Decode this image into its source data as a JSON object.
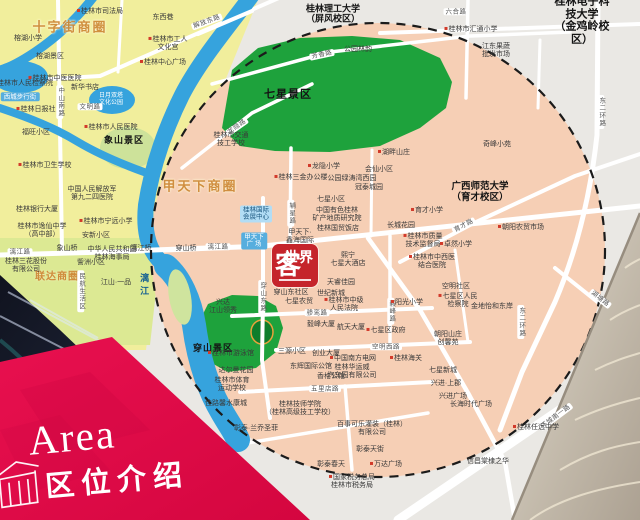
{
  "banner": {
    "title_en": "Area",
    "title_zh": "区位介绍"
  },
  "logo": {
    "char_main": "客",
    "char_sub": "世界",
    "name": "客世界"
  },
  "colors": {
    "banner_red": "#e2094a",
    "logo_red": "#c5242b",
    "map_salmon": "#f6cfb5",
    "map_yellow": "#f1ee9c",
    "park_green": "#1ea23c",
    "water_blue": "#36a3dd",
    "circle_dash": "#1b1b1b",
    "business_circle_text": "#cf8b3a",
    "texture_tan": "#b3a99b"
  },
  "map": {
    "labels": [
      {
        "t": "十字街商圈",
        "x": 70,
        "y": 28,
        "k": "area"
      },
      {
        "t": "甲天下商圈",
        "x": 200,
        "y": 187,
        "k": "area"
      },
      {
        "t": "联达商圈",
        "x": 57,
        "y": 277,
        "k": "area2"
      },
      {
        "t": "七星景区",
        "x": 288,
        "y": 95,
        "k": "district",
        "s": 11
      },
      {
        "t": "穿山景区",
        "x": 213,
        "y": 348,
        "k": "district",
        "s": 9
      },
      {
        "t": "象山景区",
        "x": 124,
        "y": 140,
        "k": "district",
        "s": 9
      },
      {
        "t": "桂林理工大学\n（屏风校区）",
        "x": 333,
        "y": 14,
        "k": "uni",
        "s": 9
      },
      {
        "t": "桂林电子科技大学\n（金鸡岭校区）",
        "x": 582,
        "y": 21,
        "k": "uni",
        "s": 11
      },
      {
        "t": "广西师范大学\n（育才校区）",
        "x": 480,
        "y": 193,
        "k": "uni",
        "s": 9.5
      },
      {
        "t": "漓江",
        "x": 144,
        "y": 286,
        "k": "water"
      },
      {
        "t": "日月双塔\n文化公园",
        "x": 111,
        "y": 100,
        "k": "lakelabel"
      },
      {
        "t": "解放东路",
        "x": 207,
        "y": 22,
        "k": "road",
        "rot": -20
      },
      {
        "t": "六合路",
        "x": 456,
        "y": 12,
        "k": "road"
      },
      {
        "t": "芳香路",
        "x": 322,
        "y": 55,
        "k": "road",
        "rot": -12
      },
      {
        "t": "龙隐路",
        "x": 237,
        "y": 127,
        "k": "road",
        "rot": -35
      },
      {
        "t": "中山南路",
        "x": 60,
        "y": 102,
        "k": "roadv"
      },
      {
        "t": "文明路",
        "x": 90,
        "y": 107,
        "k": "road"
      },
      {
        "t": "漓江路",
        "x": 20,
        "y": 252,
        "k": "road"
      },
      {
        "t": "漓江路",
        "x": 218,
        "y": 247,
        "k": "road"
      },
      {
        "t": "穿山东路",
        "x": 262,
        "y": 297,
        "k": "roadv"
      },
      {
        "t": "辅星路",
        "x": 291,
        "y": 213,
        "k": "roadv"
      },
      {
        "t": "骖鸾路",
        "x": 317,
        "y": 313,
        "k": "road"
      },
      {
        "t": "毅峰路",
        "x": 391,
        "y": 311,
        "k": "roadv"
      },
      {
        "t": "空明西路",
        "x": 386,
        "y": 347,
        "k": "road"
      },
      {
        "t": "五里店路",
        "x": 325,
        "y": 389,
        "k": "road"
      },
      {
        "t": "育才路",
        "x": 464,
        "y": 226,
        "k": "road",
        "rot": -28
      },
      {
        "t": "东二环路",
        "x": 601,
        "y": 112,
        "k": "roadv"
      },
      {
        "t": "东二环路",
        "x": 521,
        "y": 322,
        "k": "roadv"
      },
      {
        "t": "环城南一路",
        "x": 556,
        "y": 417,
        "k": "road",
        "rot": -37
      },
      {
        "t": "湖塘路",
        "x": 600,
        "y": 299,
        "k": "road",
        "rot": 38
      },
      {
        "t": "象山桥",
        "x": 67,
        "y": 249,
        "k": "place"
      },
      {
        "t": "漓江桥",
        "x": 141,
        "y": 249,
        "k": "place"
      },
      {
        "t": "穿山桥",
        "x": 186,
        "y": 249,
        "k": "place"
      },
      {
        "t": "东西巷",
        "x": 163,
        "y": 18,
        "k": "place"
      },
      {
        "t": "桂林市司法局",
        "x": 100,
        "y": 12,
        "k": "dot"
      },
      {
        "t": "桂林市工人\n文化宫",
        "x": 168,
        "y": 44,
        "k": "dot"
      },
      {
        "t": "桂林中心广场",
        "x": 163,
        "y": 63,
        "k": "dot"
      },
      {
        "t": "榕湖小学",
        "x": 28,
        "y": 39,
        "k": "place"
      },
      {
        "t": "榕湖景区",
        "x": 50,
        "y": 57,
        "k": "place"
      },
      {
        "t": "桂林市中医医院",
        "x": 55,
        "y": 79,
        "k": "dot"
      },
      {
        "t": "新华书店",
        "x": 85,
        "y": 88,
        "k": "place"
      },
      {
        "t": "西城步行街",
        "x": 20,
        "y": 97,
        "k": "blueboxw"
      },
      {
        "t": "桂林市人民检察院",
        "x": 25,
        "y": 84,
        "k": "place"
      },
      {
        "t": "桂林日报社",
        "x": 36,
        "y": 110,
        "k": "dot"
      },
      {
        "t": "桂林市人民医院",
        "x": 111,
        "y": 128,
        "k": "dot"
      },
      {
        "t": "福旺小区",
        "x": 36,
        "y": 133,
        "k": "place"
      },
      {
        "t": "桂林市卫生学校",
        "x": 45,
        "y": 166,
        "k": "dot"
      },
      {
        "t": "中国人民解放军\n第九二四医院",
        "x": 92,
        "y": 194,
        "k": "place"
      },
      {
        "t": "桂林银行大厦",
        "x": 37,
        "y": 210,
        "k": "place"
      },
      {
        "t": "桂林市逸仙中学\n（高中部）",
        "x": 42,
        "y": 231,
        "k": "place"
      },
      {
        "t": "桂林市宁远小学",
        "x": 106,
        "y": 222,
        "k": "dot"
      },
      {
        "t": "安新小区",
        "x": 96,
        "y": 236,
        "k": "place"
      },
      {
        "t": "中华人民共和国\n桂林海事局",
        "x": 112,
        "y": 254,
        "k": "place"
      },
      {
        "t": "訾洲小区",
        "x": 91,
        "y": 263,
        "k": "place"
      },
      {
        "t": "民航生活区",
        "x": 81,
        "y": 291,
        "k": "roadv"
      },
      {
        "t": "江山·一品",
        "x": 116,
        "y": 283,
        "k": "place"
      },
      {
        "t": "桂林三花股份\n有限公司",
        "x": 26,
        "y": 266,
        "k": "place"
      },
      {
        "t": "桂林市交通\n技工学校",
        "x": 231,
        "y": 140,
        "k": "place"
      },
      {
        "t": "公园林韵",
        "x": 358,
        "y": 50,
        "k": "place"
      },
      {
        "t": "湖畔山庄",
        "x": 394,
        "y": 153,
        "k": "dot"
      },
      {
        "t": "龙隐小学",
        "x": 324,
        "y": 167,
        "k": "dot"
      },
      {
        "t": "会仙小区",
        "x": 379,
        "y": 170,
        "k": "place"
      },
      {
        "t": "公园绿涛湾西园",
        "x": 352,
        "y": 179,
        "k": "place"
      },
      {
        "t": "冠泰城园",
        "x": 369,
        "y": 188,
        "k": "place"
      },
      {
        "t": "七星小区",
        "x": 331,
        "y": 200,
        "k": "place"
      },
      {
        "t": "桂林三金办公楼",
        "x": 301,
        "y": 178,
        "k": "dot"
      },
      {
        "t": "桂林国际\n会展中心",
        "x": 256,
        "y": 214,
        "k": "bluebox"
      },
      {
        "t": "甲天下\n广 场",
        "x": 254,
        "y": 241,
        "k": "blueboxw"
      },
      {
        "t": "中国有色桂林\n矿产地质研究院",
        "x": 337,
        "y": 215,
        "k": "place"
      },
      {
        "t": "桂林国贸饭店",
        "x": 338,
        "y": 229,
        "k": "place"
      },
      {
        "t": "长城花园",
        "x": 401,
        "y": 226,
        "k": "place"
      },
      {
        "t": "桂林市质量\n技术监督局",
        "x": 423,
        "y": 241,
        "k": "dot"
      },
      {
        "t": "育才小学",
        "x": 427,
        "y": 211,
        "k": "dot"
      },
      {
        "t": "奇峰小苑",
        "x": 497,
        "y": 145,
        "k": "place"
      },
      {
        "t": "朝阳农贸市场",
        "x": 521,
        "y": 228,
        "k": "dot"
      },
      {
        "t": "卓然小学",
        "x": 456,
        "y": 245,
        "k": "dot"
      },
      {
        "t": "桂林市中西医\n结合医院",
        "x": 432,
        "y": 262,
        "k": "dot"
      },
      {
        "t": "桂林市汇通小学",
        "x": 471,
        "y": 30,
        "k": "dot"
      },
      {
        "t": "江东果蔬\n批发市场",
        "x": 496,
        "y": 51,
        "k": "place"
      },
      {
        "t": "甲天下·\n鑫海国际",
        "x": 300,
        "y": 237,
        "k": "place"
      },
      {
        "t": "熙宁\n七星大酒店",
        "x": 348,
        "y": 260,
        "k": "place"
      },
      {
        "t": "天睿佳园",
        "x": 341,
        "y": 283,
        "k": "place"
      },
      {
        "t": "世纪新城",
        "x": 331,
        "y": 294,
        "k": "place"
      },
      {
        "t": "桂林市中级\n人民法院",
        "x": 344,
        "y": 305,
        "k": "dot"
      },
      {
        "t": "穿山东社区",
        "x": 291,
        "y": 293,
        "k": "place"
      },
      {
        "t": "七星农贸",
        "x": 299,
        "y": 302,
        "k": "place"
      },
      {
        "t": "毅峰大厦",
        "x": 321,
        "y": 325,
        "k": "place"
      },
      {
        "t": "航天大厦",
        "x": 351,
        "y": 328,
        "k": "place"
      },
      {
        "t": "七星区政府",
        "x": 386,
        "y": 331,
        "k": "dot"
      },
      {
        "t": "阳光小学",
        "x": 407,
        "y": 303,
        "k": "dot"
      },
      {
        "t": "空明社区",
        "x": 456,
        "y": 287,
        "k": "place"
      },
      {
        "t": "七星区人民\n检察院",
        "x": 458,
        "y": 301,
        "k": "dot"
      },
      {
        "t": "金地怡和东岸",
        "x": 492,
        "y": 307,
        "k": "place"
      },
      {
        "t": "朝阳山庄\n创馨苑",
        "x": 448,
        "y": 339,
        "k": "place"
      },
      {
        "t": "七星新城",
        "x": 443,
        "y": 371,
        "k": "place"
      },
      {
        "t": "兴进·上郡",
        "x": 446,
        "y": 384,
        "k": "place"
      },
      {
        "t": "兴进广场",
        "x": 453,
        "y": 397,
        "k": "place"
      },
      {
        "t": "长海时代广场",
        "x": 471,
        "y": 405,
        "k": "place"
      },
      {
        "t": "桂林任远中学",
        "x": 536,
        "y": 428,
        "k": "dot"
      },
      {
        "t": "信昌棠棣之华",
        "x": 488,
        "y": 462,
        "k": "place"
      },
      {
        "t": "兴达\n江山领秀",
        "x": 223,
        "y": 307,
        "k": "place"
      },
      {
        "t": "桂林市游泳馆",
        "x": 231,
        "y": 354,
        "k": "dot"
      },
      {
        "t": "达尔曼花园",
        "x": 236,
        "y": 371,
        "k": "place"
      },
      {
        "t": "桂林市体育\n运动学校",
        "x": 232,
        "y": 385,
        "k": "place"
      },
      {
        "t": "佳路馨水康城",
        "x": 226,
        "y": 404,
        "k": "place"
      },
      {
        "t": "三源小区",
        "x": 292,
        "y": 352,
        "k": "place"
      },
      {
        "t": "创业大厦",
        "x": 326,
        "y": 354,
        "k": "place"
      },
      {
        "t": "东辉国际公馆",
        "x": 311,
        "y": 367,
        "k": "place"
      },
      {
        "t": "香格公馆",
        "x": 331,
        "y": 377,
        "k": "place"
      },
      {
        "t": "中国南方电网",
        "x": 353,
        "y": 359,
        "k": "dot"
      },
      {
        "t": "桂林华运威\n汽车园有限公司",
        "x": 352,
        "y": 372,
        "k": "place"
      },
      {
        "t": "桂林海关",
        "x": 406,
        "y": 359,
        "k": "dot"
      },
      {
        "t": "桂林技师学院\n（桂林高级技工学校）",
        "x": 300,
        "y": 409,
        "k": "place"
      },
      {
        "t": "彰泰·兰乔圣菲",
        "x": 256,
        "y": 429,
        "k": "place"
      },
      {
        "t": "百事可乐灌装（桂林）\n有限公司",
        "x": 372,
        "y": 429,
        "k": "place"
      },
      {
        "t": "彰泰天街",
        "x": 370,
        "y": 450,
        "k": "place"
      },
      {
        "t": "万达广场",
        "x": 386,
        "y": 465,
        "k": "dot"
      },
      {
        "t": "彰泰春天",
        "x": 331,
        "y": 465,
        "k": "place"
      },
      {
        "t": "国家税务总局\n桂林市税务局",
        "x": 352,
        "y": 482,
        "k": "dot"
      }
    ]
  }
}
